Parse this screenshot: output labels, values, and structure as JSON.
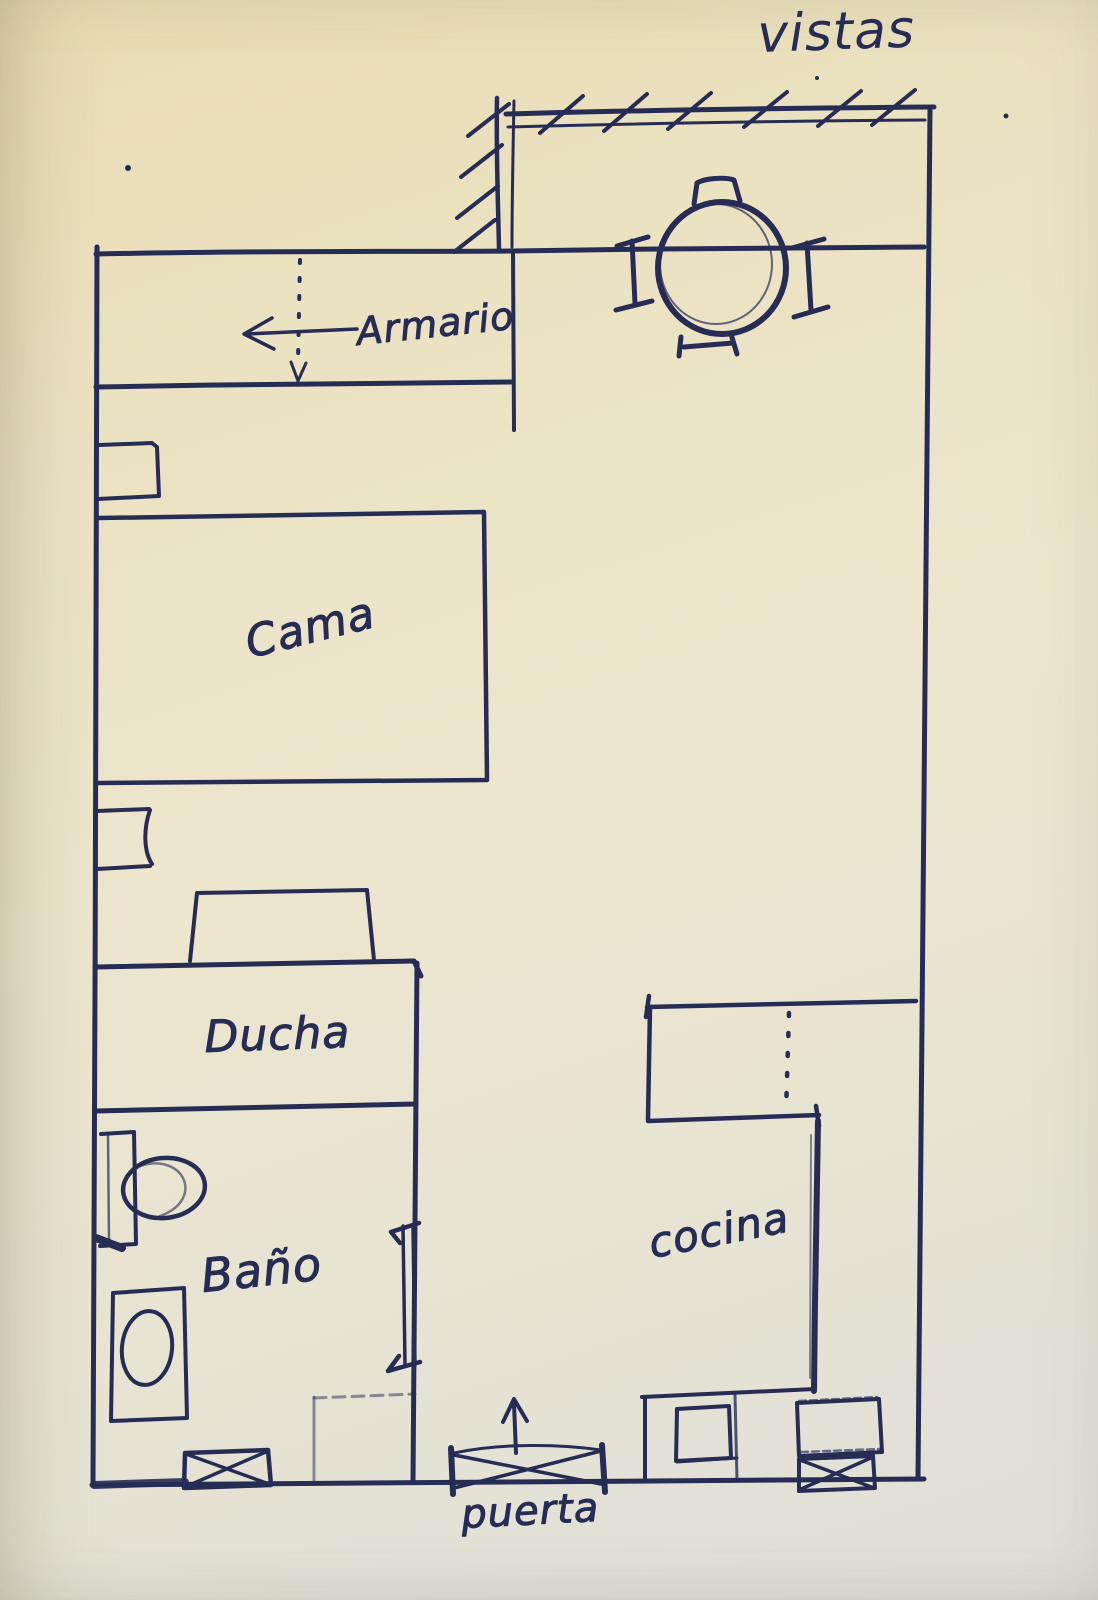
{
  "colors": {
    "ink": "#272c55",
    "paper": "#e9e1c2"
  },
  "labels": {
    "vistas": "vistas",
    "armario": "Armario",
    "cama": "Cama",
    "ducha": "Ducha",
    "bano": "Baño",
    "cocina": "cocina",
    "puerta": "puerta"
  }
}
